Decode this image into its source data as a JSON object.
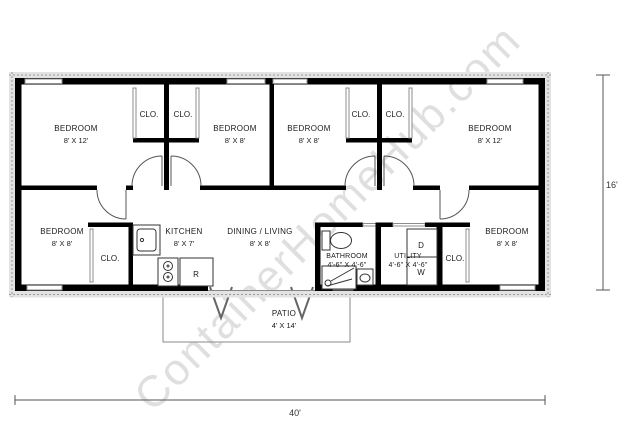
{
  "watermark": "ContainerHomeHub.com",
  "dimensions": {
    "width": "40'",
    "height": "16'"
  },
  "labels": {
    "closet": "CLO.",
    "refrigerator": "R",
    "dryer": "D",
    "washer": "W"
  },
  "rooms": {
    "bedroom_top_left": {
      "name": "BEDROOM",
      "size": "8' X 12'"
    },
    "bedroom_top_mid_left": {
      "name": "BEDROOM",
      "size": "8' X 8'"
    },
    "bedroom_top_mid_right": {
      "name": "BEDROOM",
      "size": "8' X 8'"
    },
    "bedroom_top_right": {
      "name": "BEDROOM",
      "size": "8' X 12'"
    },
    "bedroom_bottom_left": {
      "name": "BEDROOM",
      "size": "8' X 8'"
    },
    "bedroom_bottom_right": {
      "name": "BEDROOM",
      "size": "8' X 8'"
    },
    "kitchen": {
      "name": "KITCHEN",
      "size": "8' X 7'"
    },
    "dining_living": {
      "name": "DINING / LIVING",
      "size": "8' X 8'"
    },
    "bathroom": {
      "name": "BATHROOM",
      "size": "4'-6\" X 4'-6\""
    },
    "utility": {
      "name": "UTILITY",
      "size": "4'-6\" X 4'-6\""
    },
    "patio": {
      "name": "PATIO",
      "size": "4' X 14'"
    }
  },
  "colors": {
    "wall": "#000000",
    "window": "#8c8c8c",
    "watermark": "#c6c6c6"
  }
}
